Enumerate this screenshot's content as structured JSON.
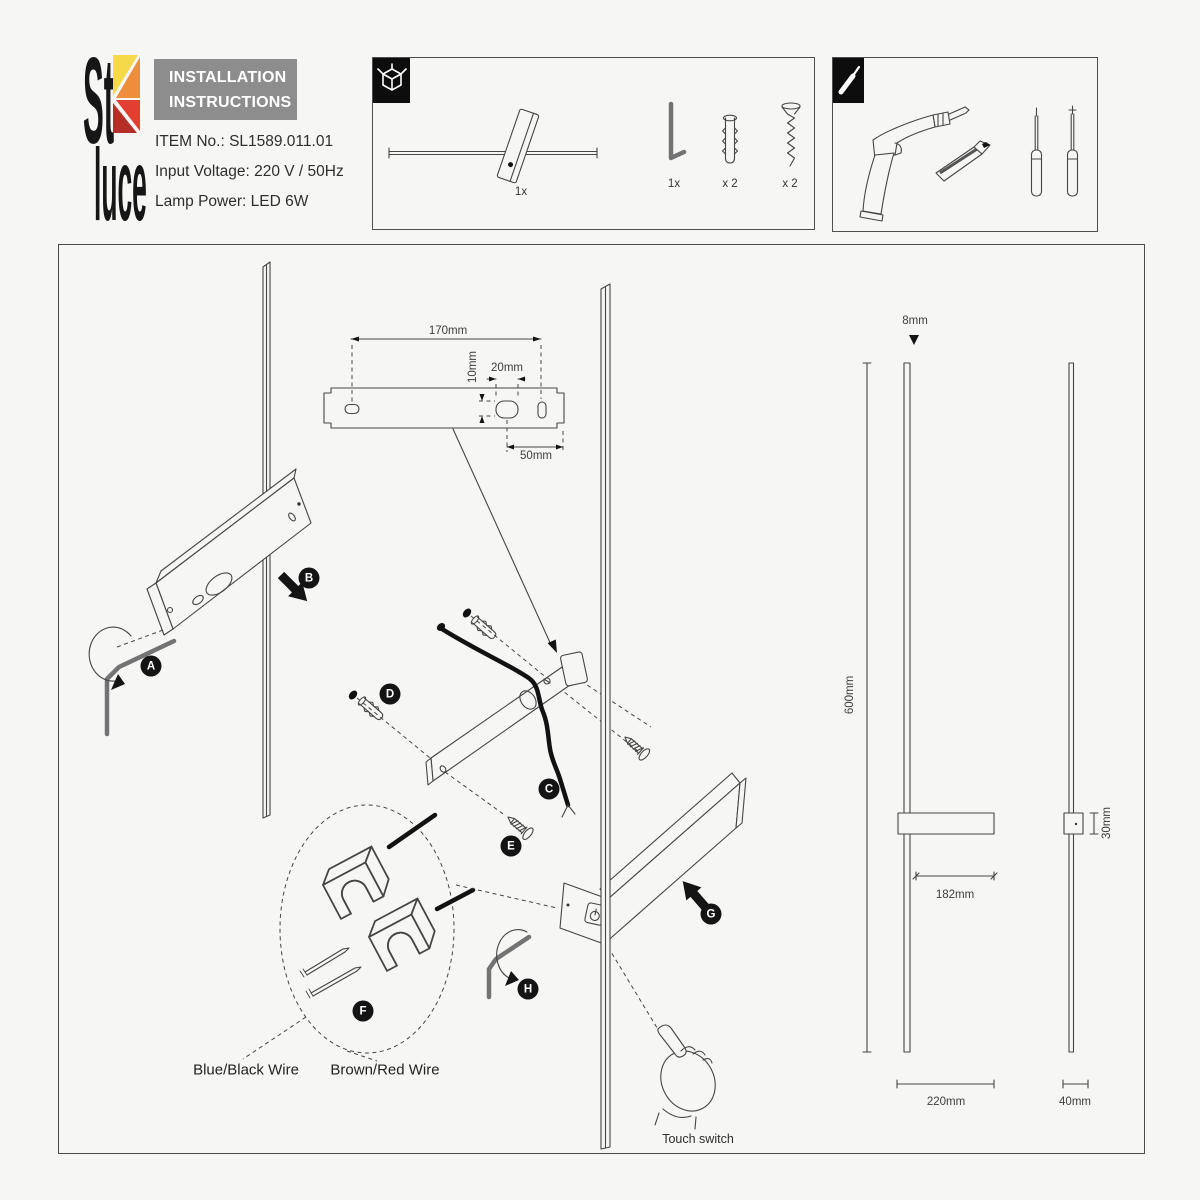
{
  "brand": {
    "logo_top": "St",
    "logo_bottom": "luce"
  },
  "header": {
    "title_line1": "INSTALLATION",
    "title_line2": "INSTRUCTIONS",
    "item_no": "ITEM No.: SL1589.011.01",
    "input_voltage": "Input Voltage: 220 V / 50Hz",
    "lamp_power": "Lamp Power: LED 6W"
  },
  "package_contents": {
    "lamp_qty": "1x",
    "hex_key_qty": "1x",
    "dowel_qty": "x 2",
    "screw_qty": "x 2"
  },
  "steps": {
    "a": "A",
    "b": "B",
    "c": "C",
    "d": "D",
    "e": "E",
    "f": "F",
    "g": "G",
    "h": "H"
  },
  "dimensions": {
    "bracket_length": "170mm",
    "hole_offset_v": "10mm",
    "slot_width": "20mm",
    "hole_to_end": "50mm",
    "rod_diameter": "8mm",
    "lamp_height": "600mm",
    "arm_length": "182mm",
    "mount_depth": "30mm",
    "base_width": "220mm",
    "side_depth": "40mm"
  },
  "wiring": {
    "blue_black": "Blue/Black Wire",
    "brown_red": "Brown/Red Wire"
  },
  "notes": {
    "touch_switch": "Touch switch"
  },
  "colors": {
    "logo_yellow": "#f6d84b",
    "logo_orange": "#ee8d3c",
    "logo_red": "#e23e31",
    "logo_dark_red": "#b52f28",
    "header_gray": "#8d8d8d",
    "line": "#454545",
    "badge": "#141414",
    "paper": "#f6f6f4"
  }
}
